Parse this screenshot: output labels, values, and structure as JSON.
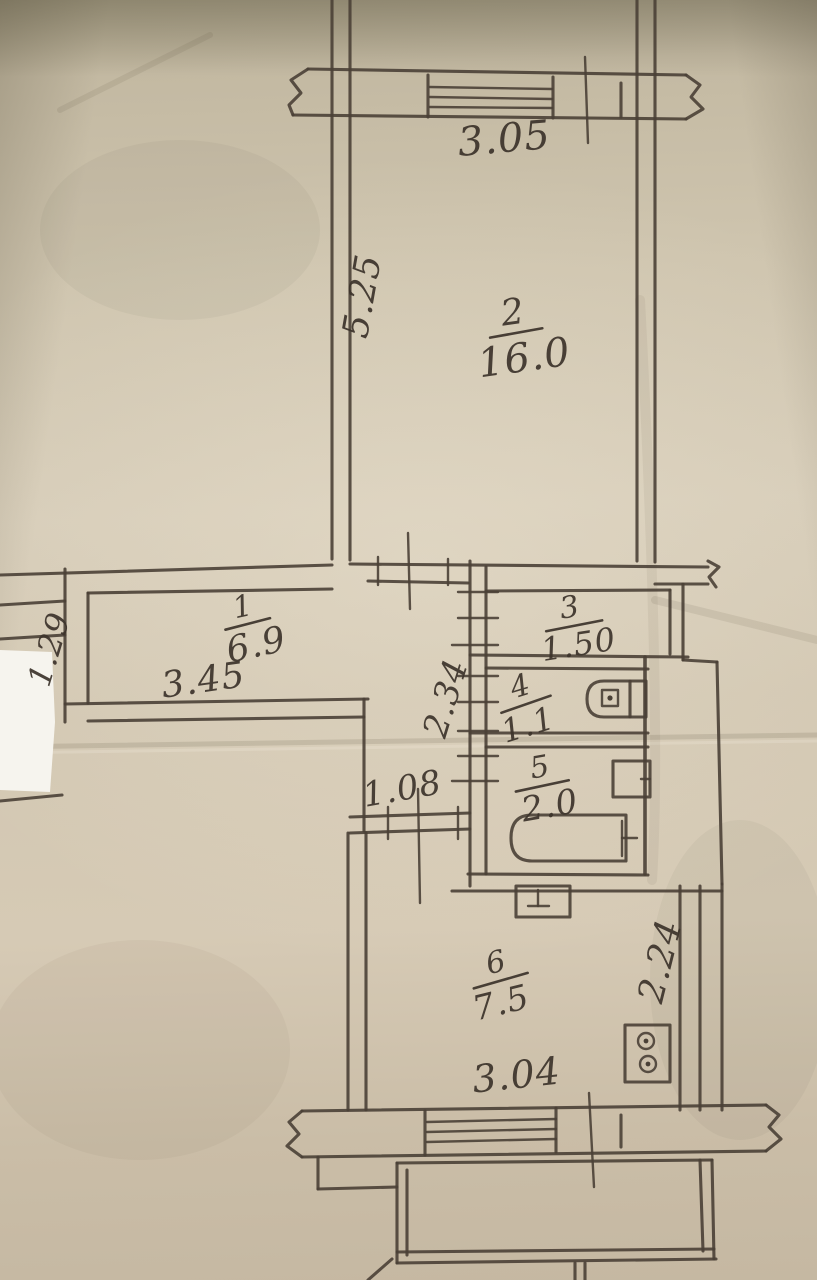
{
  "plan": {
    "type": "apartment floor plan (hand-drawn technical drawing photo)"
  },
  "rooms": {
    "r1": {
      "number": "1",
      "area": "6.9"
    },
    "r2": {
      "number": "2",
      "area": "16.0"
    },
    "r3": {
      "number": "3",
      "area": "1.50"
    },
    "r4": {
      "number": "4",
      "area": "1.1"
    },
    "r5": {
      "number": "5",
      "area": "2.0"
    },
    "r6": {
      "number": "6",
      "area": "7.5"
    }
  },
  "dimensions": {
    "top_window": "3.05",
    "room2_left": "5.25",
    "hall_left": "1.29",
    "hall_width": "3.45",
    "corridor": "2.34",
    "kitchen_door": "1.08",
    "kitchen_right": "2.24",
    "kitchen_width": "3.04"
  },
  "fixtures": {
    "toilet": "toilet-icon",
    "washbasin": "sink-icon",
    "bathtub": "bathtub-icon",
    "kitchen_sink": "kitchen-sink-icon",
    "stove": "stove-icon"
  },
  "colors": {
    "ink": "#4a4036",
    "label_ink": "#3c332b",
    "paper": "#cfc5af",
    "paper_dark": "#ada489",
    "paper_light": "#d6ccb8",
    "photo_artifact_white": "#f6f4ee"
  }
}
